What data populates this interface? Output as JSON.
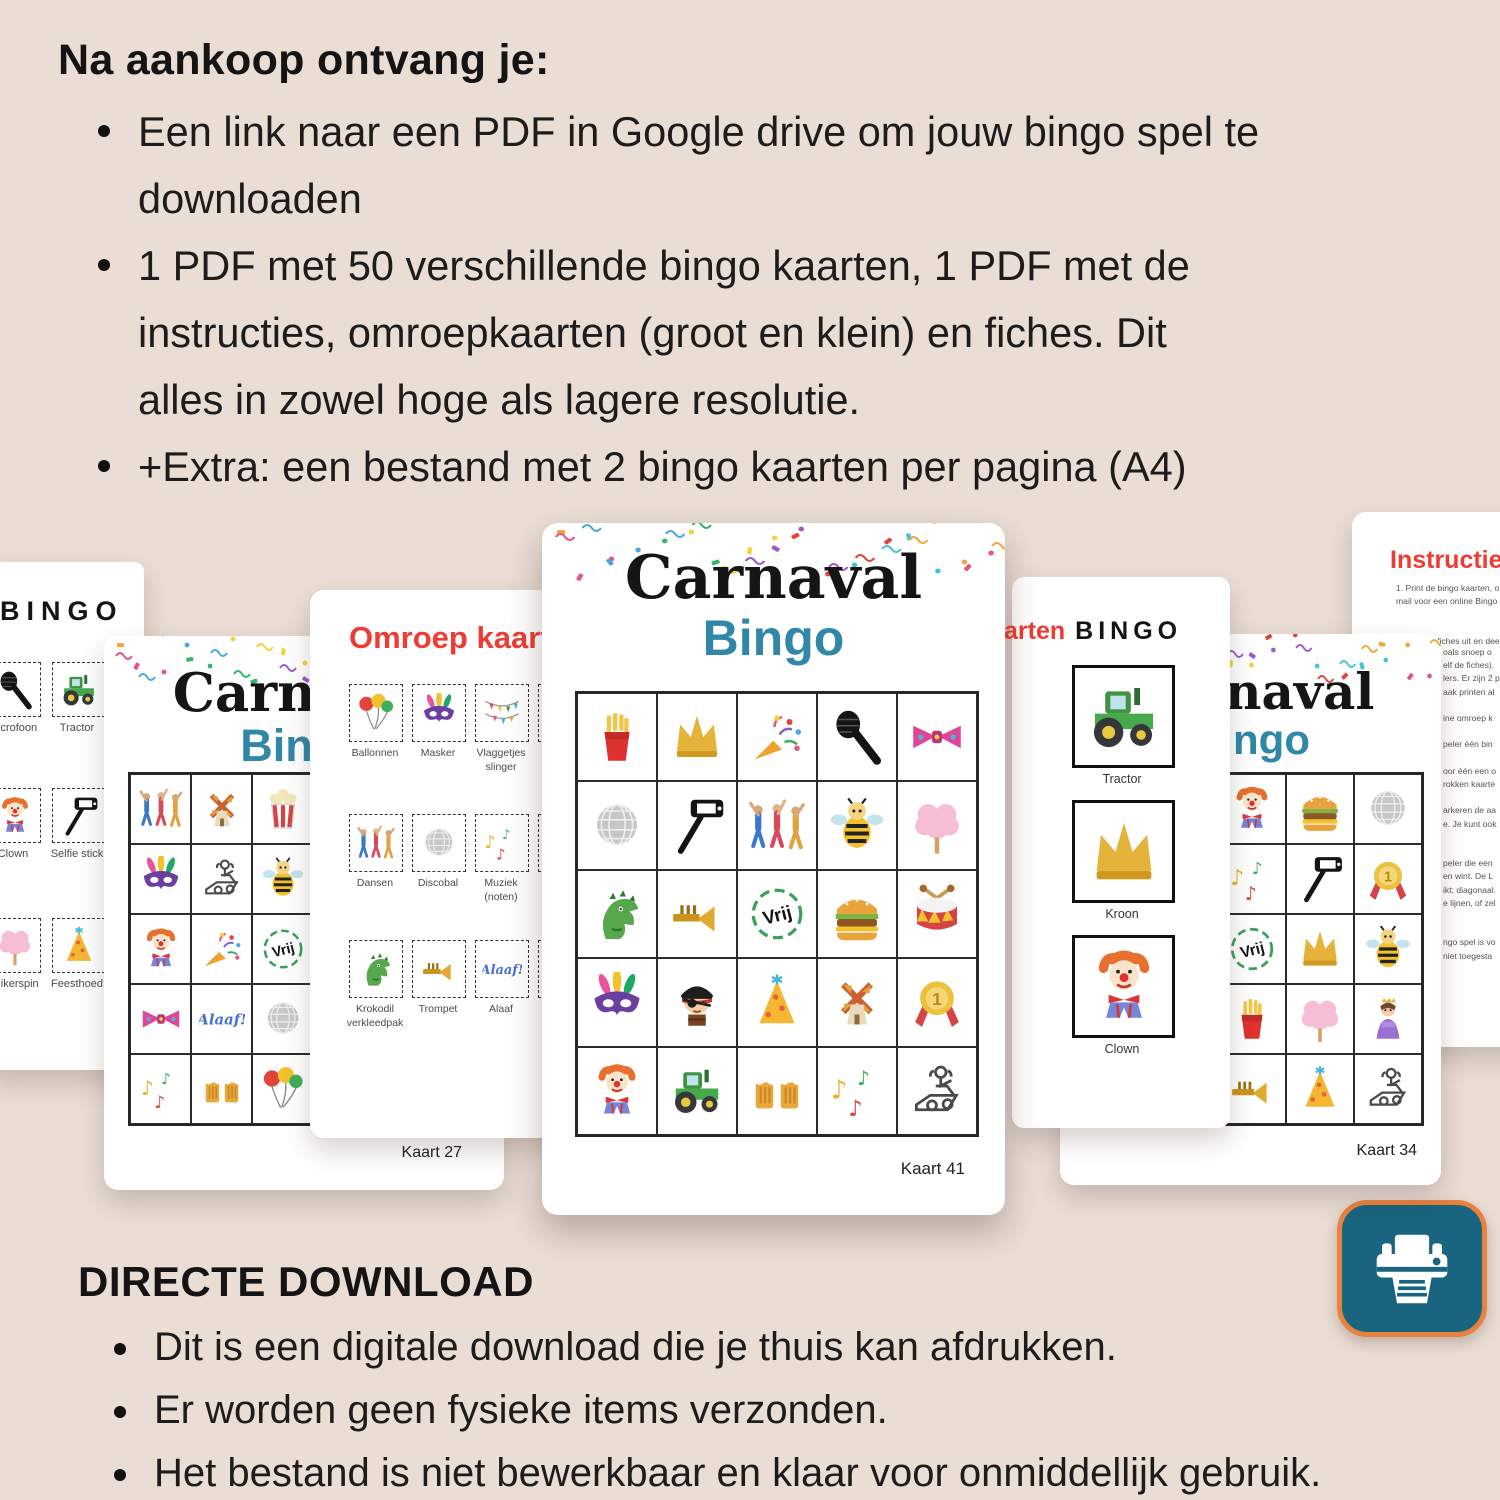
{
  "colors": {
    "background": "#e9ddd4",
    "card": "#ffffff",
    "title_black": "#151515",
    "bingo_teal": "#3187a7",
    "accent_red": "#ee3c34",
    "alaaf_blue": "#4a6fd4",
    "vrij_green": "#3aa05a",
    "printer_teal": "#19647f",
    "printer_orange": "#e8823f"
  },
  "top_section": {
    "heading": "Na aankoop ontvang je:",
    "bullets": [
      "Een link naar een PDF in Google drive om jouw bingo spel te\ndownloaden",
      "1 PDF met 50 verschillende bingo kaarten, 1 PDF met de\ninstructies, omroepkaarten (groot en klein) en fiches. Dit\nalles in zowel hoge als lagere resolutie.",
      "+Extra: een bestand met 2 bingo kaarten per pagina (A4)"
    ]
  },
  "bottom_section": {
    "heading": "DIRECTE DOWNLOAD",
    "bullets": [
      "Dit is een digitale download die je thuis kan afdrukken.",
      "Er worden geen fysieke items verzonden.",
      "Het bestand is niet bewerkbaar en klaar voor onmiddellijk gebruik."
    ]
  },
  "cards": {
    "cardA": {
      "title": "BINGO",
      "items": [
        {
          "icon": "microphone",
          "label": "Microfoon"
        },
        {
          "icon": "tractor",
          "label": "Tractor"
        },
        {
          "icon": "clown",
          "label": "Clown"
        },
        {
          "icon": "selfiestick",
          "label": "Selfie stick"
        },
        {
          "icon": "cottoncandy",
          "label": "Suikerspin"
        },
        {
          "icon": "partyhat",
          "label": "Feesthoed"
        }
      ]
    },
    "cardB": {
      "title": "Carnaval",
      "subtitle": "Bingo",
      "footer": "Kaart 27",
      "grid": [
        "dancers",
        "windmill",
        "popcorn",
        "crown",
        "fries",
        "mask",
        "dj",
        "bee",
        "selfiestick",
        "cottoncandy",
        "clown",
        "popper",
        "vrij",
        "drum",
        "microphone",
        "bowtie",
        "alaaf",
        "discoball",
        "medal",
        "trumpet",
        "musicnotes",
        "beers",
        "balloons",
        "partyhat",
        "tractor"
      ]
    },
    "cardC": {
      "title": "Omroep kaarten",
      "cells": [
        {
          "icon": "balloons",
          "label": "Ballonnen"
        },
        {
          "icon": "mask",
          "label": "Masker"
        },
        {
          "icon": "flags",
          "label": "Vlaggetjes\nslinger"
        },
        {
          "icon": "crown",
          "label": ""
        },
        {
          "icon": "dancers",
          "label": "Dansen"
        },
        {
          "icon": "discoball",
          "label": "Discobal"
        },
        {
          "icon": "musicnotes",
          "label": "Muziek\n(noten)"
        },
        {
          "icon": "fries",
          "label": ""
        },
        {
          "icon": "dino",
          "label": "Krokodil\nverkleedpak"
        },
        {
          "icon": "trumpet",
          "label": "Trompet"
        },
        {
          "icon": "alaaf",
          "label": "Alaaf"
        },
        {
          "icon": "bee",
          "label": ""
        }
      ]
    },
    "cardD": {
      "title": "Carnaval",
      "subtitle": "Bingo",
      "footer": "Kaart 41",
      "grid": [
        "fries",
        "crown",
        "popper",
        "microphone",
        "bowtie",
        "discoball",
        "selfiestick",
        "dancers",
        "bee",
        "cottoncandy",
        "dino",
        "trumpet",
        "vrij",
        "hamburger",
        "drum",
        "mask",
        "pirate",
        "partyhat",
        "windmill",
        "medal",
        "clown",
        "tractor",
        "beers",
        "musicnotes",
        "dj"
      ]
    },
    "cardE": {
      "title_red": "arten",
      "title_black": "BINGO",
      "boxes": [
        {
          "icon": "tractor",
          "label": "Tractor"
        },
        {
          "icon": "crown",
          "label": "Kroon"
        },
        {
          "icon": "clown",
          "label": "Clown"
        }
      ]
    },
    "cardF": {
      "title": "Carnaval",
      "subtitle": "Bingo",
      "footer": "Kaart 34",
      "grid": [
        "dancers",
        "bowtie",
        "clown",
        "hamburger",
        "discoball",
        "windmill",
        "drum",
        "musicnotes",
        "selfiestick",
        "medal",
        "mask",
        "tractor",
        "vrij",
        "crown",
        "bee",
        "popcorn",
        "pirate",
        "fries",
        "cottoncandy",
        "princess",
        "balloons",
        "beers",
        "trumpet",
        "partyhat",
        "dj"
      ]
    },
    "cardG": {
      "title": "Instructies vo",
      "lines_top": "1. Print de bingo kaarten, o\nmail voor een online Bingo\n\n\n2. Knip de fiches uit en dee",
      "lines_side": "oals snoep o\nelf de fiches).\nlers. Er zijn 2 p\naak printen al\n\nine omroep k\n\npeler één bin\n\noor één een o\nrokken kaarte\n\narkeren de aa\ne. Je kunt ook\n\n\npeler die een\nen wint. De L\nikt: diagonaal.\ne lijnen, of zel\n\n\nngo spel is vo\nniet toegesta"
    }
  },
  "printer_badge": {
    "icon": "printer-icon"
  }
}
